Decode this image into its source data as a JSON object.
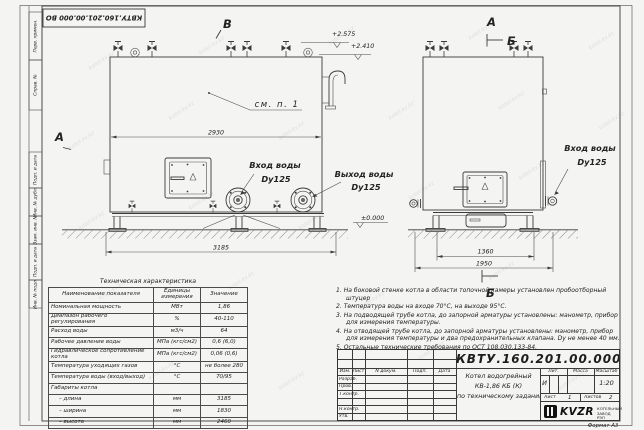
{
  "sheet": {
    "watermark": "kotel-kv.kz",
    "format_label": "Формат А3",
    "margin_labels": [
      "Перв. примен.",
      "Справ. №",
      "Подп. и дата",
      "Инв. № дубл.",
      "Взам. инв. №",
      "Подп. и дата",
      "Инв. № подл."
    ]
  },
  "views": {
    "front": {
      "label_top": "В",
      "label_left": "А",
      "callout": "см. п. 1",
      "dim_inner": "2930",
      "dim_total": "3185",
      "elev_top": "+2.575",
      "elev_mid": "+2.410",
      "elev_ground": "±0.000",
      "inlet_line1": "Вход воды",
      "inlet_line2": "Dy125",
      "outlet_line1": "Выход воды",
      "outlet_line2": "Dy125"
    },
    "side": {
      "label_top": "А",
      "section_top": "Б",
      "section_bottom": "Б",
      "dim_inner": "1360",
      "dim_total": "1950",
      "inlet_line1": "Вход воды",
      "inlet_line2": "Dy125"
    }
  },
  "spec_table": {
    "title": "Техническая характеристика",
    "headers": [
      "Наименование показателя",
      "Единицы измерения",
      "Значение"
    ],
    "rows": [
      [
        "Номинальная мощность",
        "МВт",
        "1,86"
      ],
      [
        "Диапазон рабочего регулирования",
        "%",
        "40-110"
      ],
      [
        "Расход воды",
        "м3/ч",
        "64"
      ],
      [
        "Рабочее давление воды",
        "МПа (кгс/см2)",
        "0,6 (6,0)"
      ],
      [
        "Гидравлическое сопротивление котла",
        "МПа (кгс/см2)",
        "0,06 (0,6)"
      ],
      [
        "Температура уходящих газов",
        "°С",
        "не более 280"
      ],
      [
        "Температура воды (вход/выход)",
        "°С",
        "70/95"
      ],
      [
        "Габариты котла",
        "",
        ""
      ],
      [
        "– длина",
        "мм",
        "3185"
      ],
      [
        "– ширина",
        "мм",
        "1830"
      ],
      [
        "– высота",
        "мм",
        "2460"
      ]
    ]
  },
  "notes": [
    "1. На боковой стенке котла в области топочной камеры установлен пробоотборный штуцер",
    "2. Температура воды на входе 70°С, на выходе 95°С.",
    "3. На подводящей трубе котла, до запорной арматуры установлены: манометр, прибор для измерения температуры.",
    "4. На отводящей трубе котла, до запорной арматуры установлены: манометр, прибор для измерения температуры и два предохранительных клапана. Dу не менее 40 мм.",
    "5. Остальные технические требования по ОСТ 108.030.133-84."
  ],
  "title_block": {
    "designation": "КВТУ.160.201.00.000 ВО",
    "description_line1": "Котел водогрейный",
    "description_line2": "КВ-1,86 КБ (К)",
    "description_line3": "по техническому заданию",
    "col_izm": "Изм.",
    "col_list": "Лист",
    "col_ndoc": "N докум.",
    "col_podp": "Подп.",
    "col_data": "Дата",
    "rows": [
      "Разраб.",
      "Пров.",
      "Т.контр.",
      "Н.контр.",
      "Утв."
    ],
    "lit_header": "Лит.",
    "lit_value": "И",
    "mass_header": "Масса",
    "scale_header": "Масштаб",
    "scale_value": "1:20",
    "sheet_label": "Лист",
    "sheet_value": "1",
    "sheets_label": "Листов",
    "sheets_value": "2",
    "logo_text": "KVZR",
    "company_line1": "КОТЕЛЬНЫЙ",
    "company_line2": "ЗАВОД РЭП"
  }
}
